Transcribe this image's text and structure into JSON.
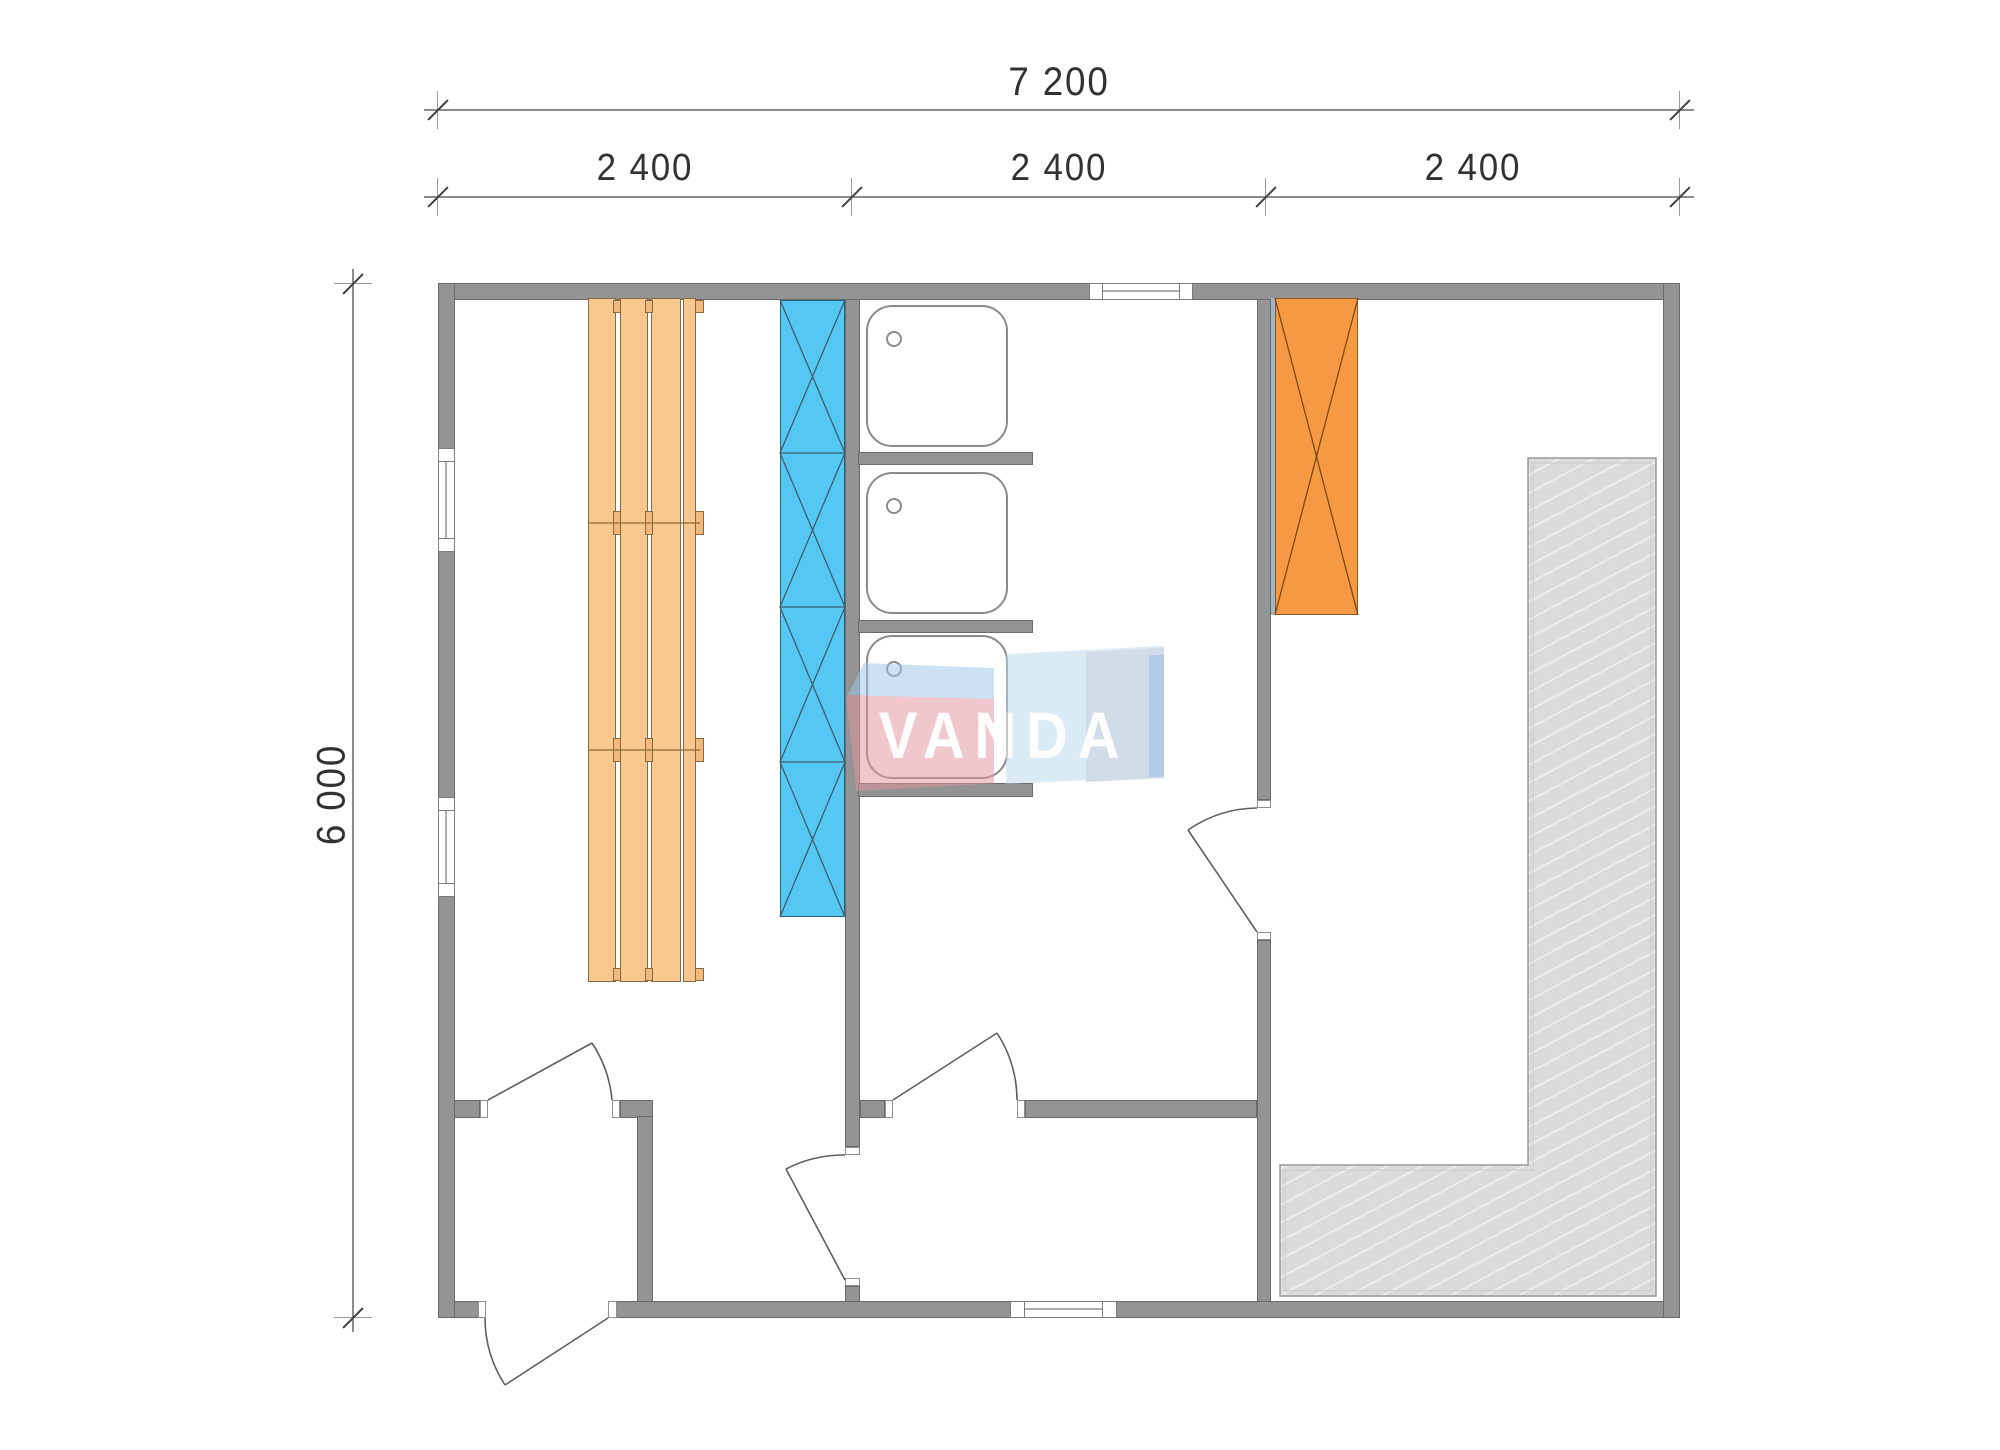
{
  "dimensions": {
    "overall_width_label": "7 200",
    "section_labels": [
      "2 400",
      "2 400",
      "2 400"
    ],
    "overall_height_label": "6 000"
  },
  "watermark": {
    "text": "VANDA",
    "colors": {
      "top_face": "#9fc9e8",
      "front_band": "#e295a0",
      "right_slab": "#bcd9ef",
      "right_inner": "#a9bed6",
      "right_edge": "#6e9ed2",
      "letters": "#ffffff"
    }
  },
  "plan": {
    "wall_color": "#949494",
    "window_count": 4,
    "door_count": 5,
    "elements": [
      {
        "name": "sauna-benches",
        "color": "#f9c88e",
        "plank_count": 4
      },
      {
        "name": "heater-column",
        "color": "#55c7f3",
        "segment_count": 4
      },
      {
        "name": "shower-trays",
        "color": "#ffffff",
        "count": 3
      },
      {
        "name": "cabinet-unit",
        "color": "#f59a42",
        "count": 1
      },
      {
        "name": "terrace-deck",
        "color": "#dbdbdb"
      }
    ]
  }
}
